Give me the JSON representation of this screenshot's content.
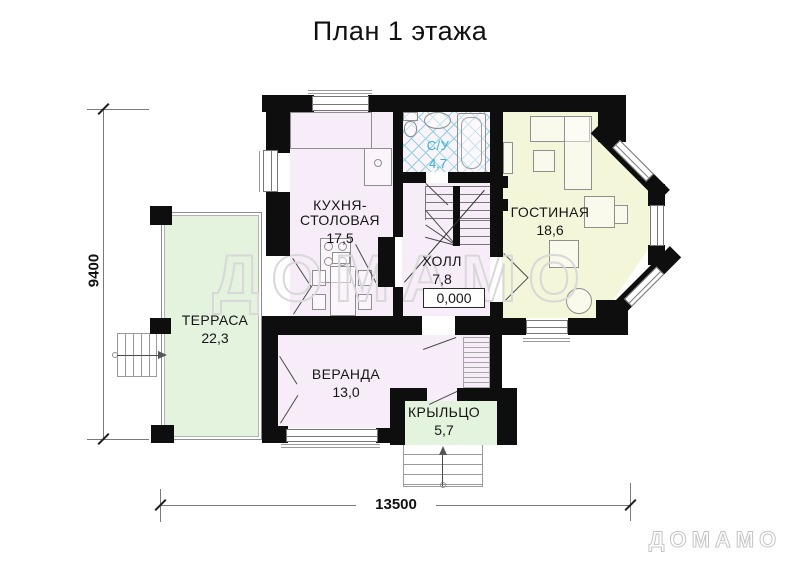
{
  "title": "План 1 этажа",
  "watermark": {
    "center": "ДОМАМО",
    "corner": "ДОМАМО"
  },
  "dimensions": {
    "height_mm": "9400",
    "width_mm": "13500"
  },
  "rooms": {
    "kitchen": {
      "name_line1": "КУХНЯ-",
      "name_line2": "СТОЛОВАЯ",
      "area": "17,5"
    },
    "bathroom": {
      "name": "С/У",
      "area": "4,7"
    },
    "hall": {
      "name": "ХОЛЛ",
      "area": "7,8",
      "elevation_mark": "0,000"
    },
    "living": {
      "name": "ГОСТИНАЯ",
      "area": "18,6"
    },
    "terrace": {
      "name": "ТЕРРАСА",
      "area": "22,3"
    },
    "veranda": {
      "name": "ВЕРАНДА",
      "area": "13,0"
    },
    "porch": {
      "name": "КРЫЛЬЦО",
      "area": "5,7"
    }
  },
  "colors": {
    "wall": "#0e0e0e",
    "room_pink": "#f7edf8",
    "room_yellow": "#f4f6da",
    "room_green": "#e3f3de",
    "bath_tile_line": "#8fd2e8",
    "bath_label": "#2fb3dc",
    "furniture_line": "#8f8f8f",
    "watermark_line": "#d8d8d8",
    "dim_line": "#7a7a7a"
  }
}
